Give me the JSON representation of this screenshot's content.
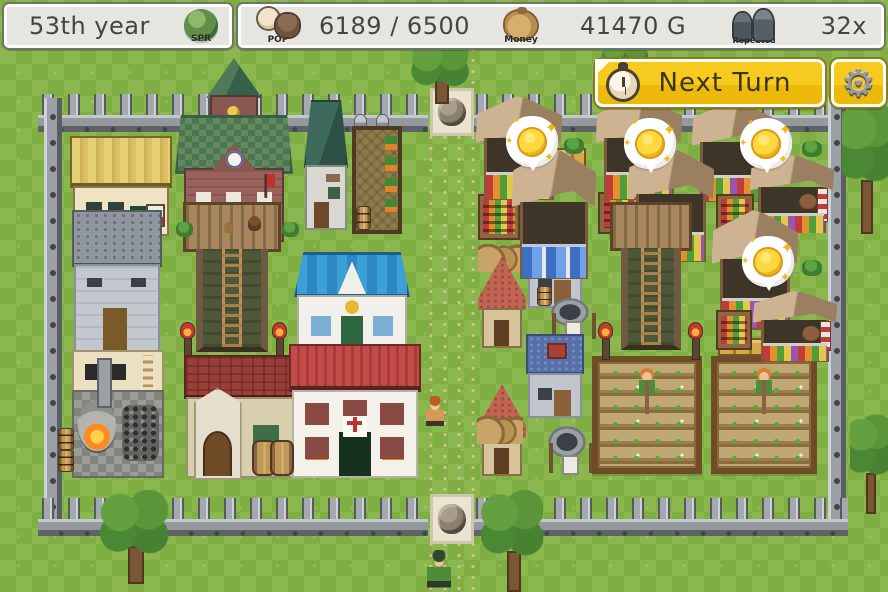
{
  "hud": {
    "year_panel": {
      "year_text": "53th year",
      "season_label": "SPR"
    },
    "stats_panel": {
      "population": {
        "icon_label": "POP",
        "value": "6189 / 6500"
      },
      "money": {
        "icon_label": "Money",
        "value": "41470 G"
      },
      "repeat": {
        "icon_label": "Repeated",
        "value": "32x"
      }
    },
    "next_turn_button": {
      "label": "Next Turn",
      "icon": "alarm-clock-icon"
    },
    "settings_button": {
      "icon": "gear-icon",
      "glyph": "⚙"
    }
  },
  "colors": {
    "accent_gold": "#f2c41c",
    "panel_bg": "#e6e5e0",
    "hud_text": "#45453e",
    "grass_light": "#8ab84e",
    "grass_dark": "#7fae43",
    "road": "#f0e0bd",
    "coin_gold": "#ffd83e",
    "fence_gray": "#9aa0a6",
    "bubble_white": "#ffffff"
  },
  "scene": {
    "entities": [
      {
        "t": "road",
        "x": 424,
        "y": 44,
        "w": 52,
        "h": 548,
        "n": "dirt-road",
        "i": false
      },
      {
        "t": "fenceH",
        "x": 38,
        "y": 94,
        "w": 390,
        "h": 42,
        "n": "fence-top-left",
        "i": false
      },
      {
        "t": "fenceH",
        "x": 472,
        "y": 94,
        "w": 376,
        "h": 42,
        "n": "fence-top-right",
        "i": false
      },
      {
        "t": "fenceV",
        "x": 44,
        "y": 98,
        "w": 18,
        "h": 428,
        "n": "fence-left",
        "i": false
      },
      {
        "t": "fenceV",
        "x": 828,
        "y": 98,
        "w": 18,
        "h": 428,
        "n": "fence-right",
        "i": false
      },
      {
        "t": "fenceH",
        "x": 38,
        "y": 498,
        "w": 390,
        "h": 42,
        "n": "fence-bottom-left",
        "i": false
      },
      {
        "t": "fenceH",
        "x": 472,
        "y": 498,
        "w": 376,
        "h": 42,
        "n": "fence-bottom-right",
        "i": false
      },
      {
        "t": "gate",
        "x": 430,
        "y": 88,
        "w": 44,
        "h": 48,
        "n": "north-gate-stone",
        "i": false
      },
      {
        "t": "gate",
        "x": 430,
        "y": 494,
        "w": 44,
        "h": 50,
        "n": "south-gate-stone",
        "i": false
      },
      {
        "t": "townhall",
        "x": 175,
        "y": 58,
        "w": 118,
        "h": 184,
        "n": "town-hall",
        "i": true
      },
      {
        "t": "weaponshop",
        "x": 70,
        "y": 136,
        "w": 102,
        "h": 100,
        "n": "thatched-shop",
        "i": true
      },
      {
        "t": "smallstone",
        "x": 302,
        "y": 100,
        "w": 48,
        "h": 130,
        "n": "small-stone-house",
        "i": true
      },
      {
        "t": "statue",
        "x": 354,
        "y": 114,
        "w": 13,
        "h": 16,
        "n": "garden-statue",
        "i": false
      },
      {
        "t": "statue",
        "x": 376,
        "y": 114,
        "w": 13,
        "h": 16,
        "n": "garden-statue",
        "i": false
      },
      {
        "t": "garden",
        "x": 352,
        "y": 126,
        "w": 50,
        "h": 108,
        "n": "hops-garden",
        "i": true
      },
      {
        "t": "barrel",
        "x": 356,
        "y": 206,
        "w": 15,
        "h": 24,
        "n": "barrel",
        "i": false
      },
      {
        "t": "warehouse",
        "x": 72,
        "y": 210,
        "w": 90,
        "h": 142,
        "n": "stone-warehouse",
        "i": true
      },
      {
        "t": "watchtower",
        "x": 183,
        "y": 202,
        "w": 98,
        "h": 150,
        "v": "furnished",
        "n": "watchtower-left",
        "i": true
      },
      {
        "t": "bush",
        "x": 176,
        "y": 222,
        "w": 17,
        "h": 15,
        "n": "bush",
        "i": false
      },
      {
        "t": "bush",
        "x": 282,
        "y": 222,
        "w": 17,
        "h": 15,
        "n": "bush",
        "i": false
      },
      {
        "t": "innblue",
        "x": 294,
        "y": 252,
        "w": 116,
        "h": 98,
        "n": "blue-roof-inn",
        "i": true
      },
      {
        "t": "torch",
        "x": 180,
        "y": 322,
        "w": 14,
        "h": 36,
        "n": "torch-post",
        "i": false
      },
      {
        "t": "torch",
        "x": 272,
        "y": 322,
        "w": 14,
        "h": 36,
        "n": "torch-post",
        "i": false
      },
      {
        "t": "blacksmith",
        "x": 72,
        "y": 350,
        "w": 92,
        "h": 128,
        "n": "blacksmith-yard",
        "i": true
      },
      {
        "t": "chapel",
        "x": 184,
        "y": 355,
        "w": 118,
        "h": 123,
        "n": "stone-chapel-house",
        "i": true
      },
      {
        "t": "clinic",
        "x": 289,
        "y": 344,
        "w": 132,
        "h": 134,
        "n": "clinic-red-roof",
        "i": true
      },
      {
        "t": "barrels",
        "x": 252,
        "y": 440,
        "w": 42,
        "h": 32,
        "n": "barrels",
        "i": false
      },
      {
        "t": "barrel",
        "x": 58,
        "y": 428,
        "w": 16,
        "h": 22,
        "n": "barrel",
        "i": false
      },
      {
        "t": "barrel",
        "x": 58,
        "y": 450,
        "w": 16,
        "h": 22,
        "n": "barrel",
        "i": false
      },
      {
        "t": "sacks",
        "x": 478,
        "y": 244,
        "w": 46,
        "h": 28,
        "n": "grain-sacks",
        "i": false
      },
      {
        "t": "pinkhouse",
        "x": 478,
        "y": 256,
        "w": 48,
        "h": 92,
        "n": "pink-roof-cottage",
        "i": true
      },
      {
        "t": "bluehouse",
        "x": 526,
        "y": 226,
        "w": 58,
        "h": 82,
        "n": "blue-roof-cottage",
        "i": true
      },
      {
        "t": "barrel",
        "x": 537,
        "y": 286,
        "w": 15,
        "h": 20,
        "n": "barrel",
        "i": false
      },
      {
        "t": "well",
        "x": 548,
        "y": 298,
        "w": 44,
        "h": 44,
        "n": "stone-well",
        "i": true
      },
      {
        "t": "bluehouse",
        "x": 526,
        "y": 334,
        "w": 58,
        "h": 84,
        "n": "blue-roof-cottage-2",
        "i": true
      },
      {
        "t": "pinkhouse",
        "x": 478,
        "y": 384,
        "w": 48,
        "h": 92,
        "n": "pink-roof-cottage-2",
        "i": true
      },
      {
        "t": "sacks",
        "x": 477,
        "y": 416,
        "w": 46,
        "h": 28,
        "n": "grain-sacks",
        "i": false
      },
      {
        "t": "well",
        "x": 545,
        "y": 426,
        "w": 44,
        "h": 50,
        "n": "stone-well-2",
        "i": true
      },
      {
        "t": "farm",
        "x": 592,
        "y": 356,
        "w": 110,
        "h": 118,
        "n": "crop-field-left",
        "i": true
      },
      {
        "t": "farm",
        "x": 711,
        "y": 356,
        "w": 106,
        "h": 118,
        "n": "crop-field-right",
        "i": true
      },
      {
        "t": "crates",
        "x": 718,
        "y": 338,
        "w": 58,
        "h": 18,
        "n": "harvest-crates",
        "i": false
      },
      {
        "t": "torch",
        "x": 598,
        "y": 322,
        "w": 14,
        "h": 36,
        "n": "torch-post",
        "i": false
      },
      {
        "t": "torch",
        "x": 688,
        "y": 322,
        "w": 14,
        "h": 36,
        "n": "torch-post",
        "i": false
      },
      {
        "t": "shelf",
        "x": 478,
        "y": 194,
        "w": 42,
        "h": 46,
        "n": "produce-shelf",
        "i": false
      },
      {
        "t": "stall",
        "x": 478,
        "y": 96,
        "w": 82,
        "h": 106,
        "n": "market-stall-1",
        "i": true
      },
      {
        "t": "crates",
        "x": 556,
        "y": 148,
        "w": 30,
        "h": 32,
        "n": "crates",
        "i": false
      },
      {
        "t": "bush",
        "x": 564,
        "y": 138,
        "w": 20,
        "h": 16,
        "n": "bush",
        "i": false
      },
      {
        "t": "shelf",
        "x": 598,
        "y": 192,
        "w": 48,
        "h": 42,
        "n": "produce-shelf",
        "i": false
      },
      {
        "t": "stall",
        "x": 598,
        "y": 96,
        "w": 82,
        "h": 106,
        "n": "market-stall-2",
        "i": true
      },
      {
        "t": "stall",
        "x": 694,
        "y": 100,
        "w": 80,
        "h": 104,
        "n": "market-stall-3",
        "i": true
      },
      {
        "t": "bush",
        "x": 802,
        "y": 141,
        "w": 20,
        "h": 16,
        "n": "bush",
        "i": false
      },
      {
        "t": "stall",
        "x": 514,
        "y": 148,
        "w": 80,
        "h": 134,
        "v": "blue",
        "n": "market-stall-4",
        "i": true
      },
      {
        "t": "stall",
        "x": 630,
        "y": 148,
        "w": 82,
        "h": 116,
        "n": "market-stall-5",
        "i": true
      },
      {
        "t": "stall",
        "x": 752,
        "y": 155,
        "w": 80,
        "h": 80,
        "v": "pole vendor",
        "n": "market-stall-6",
        "i": true
      },
      {
        "t": "watchtower",
        "x": 610,
        "y": 202,
        "w": 82,
        "h": 148,
        "n": "watchtower-right",
        "i": true
      },
      {
        "t": "shelf",
        "x": 716,
        "y": 194,
        "w": 38,
        "h": 36,
        "n": "produce-shelf",
        "i": false
      },
      {
        "t": "stall",
        "x": 714,
        "y": 210,
        "w": 82,
        "h": 122,
        "n": "market-stall-7",
        "i": true
      },
      {
        "t": "bush",
        "x": 802,
        "y": 260,
        "w": 20,
        "h": 16,
        "n": "bush",
        "i": false
      },
      {
        "t": "shelf",
        "x": 716,
        "y": 310,
        "w": 36,
        "h": 40,
        "n": "produce-shelf",
        "i": false
      },
      {
        "t": "stall",
        "x": 755,
        "y": 291,
        "w": 80,
        "h": 72,
        "v": "pole vendor",
        "n": "market-stall-8",
        "i": true
      },
      {
        "t": "tree",
        "x": 408,
        "y": 42,
        "w": 64,
        "h": 62,
        "n": "tree",
        "i": false
      },
      {
        "t": "tree",
        "x": 598,
        "y": 40,
        "w": 54,
        "h": 26,
        "v": "blob",
        "n": "tree",
        "i": false
      },
      {
        "t": "tree",
        "x": 842,
        "y": 96,
        "w": 46,
        "h": 138,
        "n": "tree",
        "i": false
      },
      {
        "t": "tree",
        "x": 850,
        "y": 410,
        "w": 38,
        "h": 104,
        "n": "tree",
        "i": false
      },
      {
        "t": "tree",
        "x": 98,
        "y": 490,
        "w": 72,
        "h": 94,
        "n": "tree",
        "i": false
      },
      {
        "t": "tree",
        "x": 481,
        "y": 488,
        "w": 62,
        "h": 104,
        "n": "tree",
        "i": false
      },
      {
        "t": "coin",
        "x": 506,
        "y": 116,
        "w": 52,
        "h": 60,
        "n": "coin-bubble-1",
        "i": true
      },
      {
        "t": "coin",
        "x": 624,
        "y": 118,
        "w": 52,
        "h": 60,
        "n": "coin-bubble-2",
        "i": true
      },
      {
        "t": "coin",
        "x": 740,
        "y": 118,
        "w": 52,
        "h": 60,
        "n": "coin-bubble-3",
        "i": true
      },
      {
        "t": "coin",
        "x": 742,
        "y": 236,
        "w": 52,
        "h": 60,
        "n": "coin-bubble-4",
        "i": true
      },
      {
        "t": "villager",
        "x": 426,
        "y": 396,
        "w": 18,
        "h": 32,
        "v": "tan",
        "n": "villager",
        "i": false
      },
      {
        "t": "villager",
        "x": 427,
        "y": 550,
        "w": 24,
        "h": 40,
        "v": "green",
        "n": "villager",
        "i": false
      }
    ]
  }
}
